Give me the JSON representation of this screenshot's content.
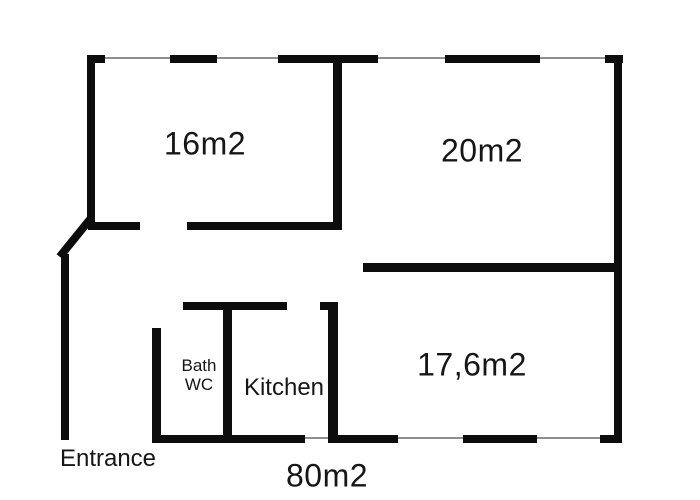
{
  "plan": {
    "rooms": [
      {
        "id": "room-16",
        "label": "16m2"
      },
      {
        "id": "room-20",
        "label": "20m2"
      },
      {
        "id": "room-176",
        "label": "17,6m2"
      },
      {
        "id": "bath-wc",
        "label_line1": "Bath",
        "label_line2": "WC"
      },
      {
        "id": "kitchen",
        "label": "Kitchen"
      }
    ],
    "entrance_label": "Entrance",
    "total_area_label": "80m2",
    "colors": {
      "wall": "#0d0d0d",
      "window_line": "#8f8f8f",
      "background": "#ffffff",
      "text": "#161616"
    }
  }
}
